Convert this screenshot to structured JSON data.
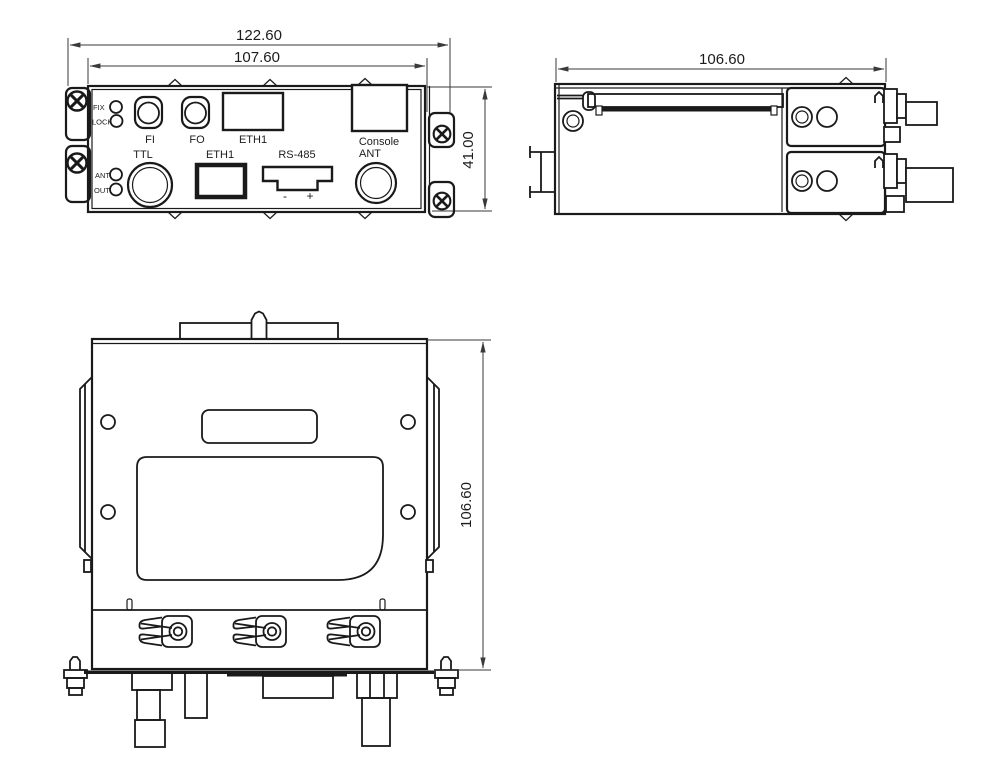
{
  "front_view": {
    "dim_overall_width": "122.60",
    "dim_panel_width": "107.60",
    "dim_height": "41.00",
    "led_labels": {
      "fix": "FIX",
      "lock": "LOCK",
      "ant": "ANT",
      "out": "OUT"
    },
    "top_row": {
      "fi": "FI",
      "fo": "FO",
      "eth1": "ETH1",
      "console": "Console"
    },
    "bottom_row": {
      "ttl": "TTL",
      "eth1": "ETH1",
      "rs485": "RS-485",
      "ant": "ANT"
    },
    "rs485_polarity": {
      "minus": "-",
      "plus": "+"
    }
  },
  "side_view": {
    "dim_depth": "106.60"
  },
  "bottom_view": {
    "dim_height": "106.60"
  },
  "colors": {
    "line": "#1a1a1a",
    "dimension": "#3a3a3a",
    "background": "#ffffff"
  }
}
